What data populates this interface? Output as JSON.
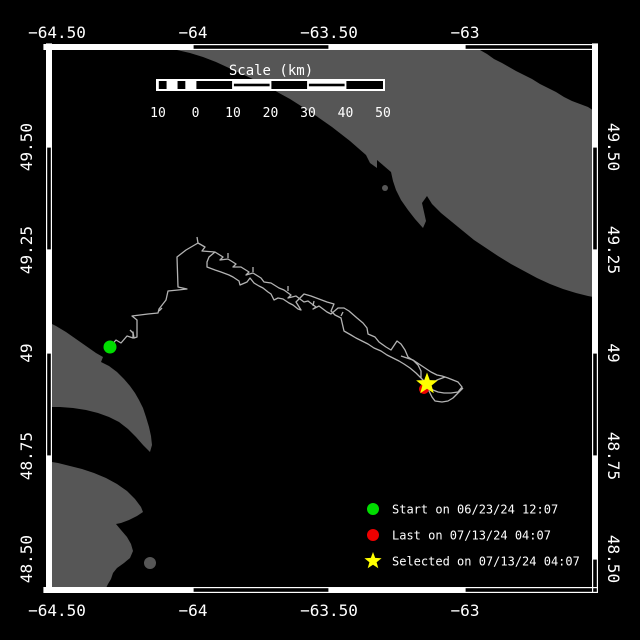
{
  "colors": {
    "background": "#000000",
    "land": "#565656",
    "track": "#b3b3b3",
    "frame": "#ffffff",
    "start": "#00dd00",
    "last": "#ee0000",
    "selected": "#ffff00"
  },
  "plot": {
    "left": 46,
    "top": 44,
    "right": 598,
    "bottom": 593,
    "band": 6,
    "inner": [
      52,
      50,
      592,
      587
    ]
  },
  "frame": {
    "top": [
      [
        44,
        193,
        "solid"
      ],
      [
        193,
        329,
        "open"
      ],
      [
        329,
        465,
        "solid"
      ],
      [
        465,
        598,
        "open"
      ]
    ],
    "bottom": [
      [
        44,
        193,
        "solid"
      ],
      [
        193,
        329,
        "open"
      ],
      [
        329,
        465,
        "solid"
      ],
      [
        465,
        598,
        "open"
      ]
    ],
    "left": [
      [
        44,
        147,
        "solid"
      ],
      [
        147,
        250,
        "open"
      ],
      [
        250,
        353,
        "solid"
      ],
      [
        353,
        456,
        "open"
      ],
      [
        456,
        593,
        "solid"
      ]
    ],
    "right": [
      [
        44,
        147,
        "solid"
      ],
      [
        147,
        250,
        "open"
      ],
      [
        250,
        353,
        "solid"
      ],
      [
        353,
        456,
        "open"
      ],
      [
        456,
        559,
        "solid"
      ],
      [
        559,
        593,
        "open"
      ]
    ]
  },
  "axes": {
    "top": [
      {
        "label": "−64.50",
        "x": 57
      },
      {
        "label": "−64",
        "x": 193
      },
      {
        "label": "−63.50",
        "x": 329
      },
      {
        "label": "−63",
        "x": 465
      }
    ],
    "bottom": [
      {
        "label": "−64.50",
        "x": 57
      },
      {
        "label": "−64",
        "x": 193
      },
      {
        "label": "−63.50",
        "x": 329
      },
      {
        "label": "−63",
        "x": 465
      }
    ],
    "left": [
      {
        "label": "49.50",
        "y": 147
      },
      {
        "label": "49.25",
        "y": 250
      },
      {
        "label": "49",
        "y": 353
      },
      {
        "label": "48.75",
        "y": 456
      },
      {
        "label": "48.50",
        "y": 559
      }
    ],
    "right": [
      {
        "label": "49.50",
        "y": 147
      },
      {
        "label": "49.25",
        "y": 250
      },
      {
        "label": "49",
        "y": 353
      },
      {
        "label": "48.75",
        "y": 456
      },
      {
        "label": "48.50",
        "y": 559
      }
    ]
  },
  "scalebar": {
    "title": "Scale (km)",
    "title_x": 271,
    "title_y": 75,
    "x": 158,
    "y": 81,
    "h": 8,
    "section_w": 37.5,
    "sections": [
      "subdivided",
      "solid",
      "striped",
      "solid",
      "striped",
      "solid"
    ],
    "labels": [
      {
        "text": "10",
        "x": 158
      },
      {
        "text": "0",
        "x": 195.5
      },
      {
        "text": "10",
        "x": 233
      },
      {
        "text": "20",
        "x": 270.5
      },
      {
        "text": "30",
        "x": 308
      },
      {
        "text": "40",
        "x": 345.5
      },
      {
        "text": "50",
        "x": 383
      }
    ],
    "labels_y": 117
  },
  "land": {
    "polygons": {
      "north_shore": [
        [
          155,
          48
        ],
        [
          250,
          49
        ],
        [
          360,
          50
        ],
        [
          480,
          50
        ],
        [
          487,
          54
        ],
        [
          494,
          59
        ],
        [
          502,
          63
        ],
        [
          509,
          67
        ],
        [
          516,
          71
        ],
        [
          524,
          75
        ],
        [
          532,
          79
        ],
        [
          540,
          84
        ],
        [
          548,
          88
        ],
        [
          556,
          92
        ],
        [
          564,
          97
        ],
        [
          572,
          101
        ],
        [
          580,
          104
        ],
        [
          588,
          107
        ],
        [
          594,
          111
        ],
        [
          598,
          114
        ],
        [
          598,
          298
        ],
        [
          588,
          296
        ],
        [
          576,
          293
        ],
        [
          563,
          289
        ],
        [
          550,
          284
        ],
        [
          537,
          278
        ],
        [
          524,
          271
        ],
        [
          511,
          264
        ],
        [
          498,
          256
        ],
        [
          486,
          248
        ],
        [
          474,
          240
        ],
        [
          463,
          231
        ],
        [
          452,
          222
        ],
        [
          441,
          213
        ],
        [
          432,
          204
        ],
        [
          427,
          196
        ],
        [
          422,
          203
        ],
        [
          426,
          221
        ],
        [
          423,
          228
        ],
        [
          415,
          219
        ],
        [
          408,
          210
        ],
        [
          401,
          200
        ],
        [
          396,
          190
        ],
        [
          393,
          181
        ],
        [
          391,
          172
        ],
        [
          384,
          166
        ],
        [
          377,
          160
        ],
        [
          377,
          168
        ],
        [
          370,
          163
        ],
        [
          366,
          155
        ],
        [
          358,
          148
        ],
        [
          350,
          141
        ],
        [
          341,
          134
        ],
        [
          332,
          127
        ],
        [
          322,
          120
        ],
        [
          312,
          113
        ],
        [
          301,
          106
        ],
        [
          290,
          99
        ],
        [
          279,
          93
        ],
        [
          267,
          86
        ],
        [
          255,
          80
        ],
        [
          242,
          74
        ],
        [
          229,
          68
        ],
        [
          216,
          62
        ],
        [
          203,
          57
        ],
        [
          190,
          53
        ],
        [
          177,
          50
        ],
        [
          166,
          49
        ]
      ],
      "gaspe_upper": [
        [
          46,
          321
        ],
        [
          56,
          326
        ],
        [
          66,
          332
        ],
        [
          76,
          339
        ],
        [
          86,
          346
        ],
        [
          96,
          353
        ],
        [
          103,
          357
        ],
        [
          101,
          362
        ],
        [
          109,
          366
        ],
        [
          117,
          372
        ],
        [
          124,
          379
        ],
        [
          130,
          386
        ],
        [
          135,
          393
        ],
        [
          139,
          400
        ],
        [
          143,
          408
        ],
        [
          146,
          417
        ],
        [
          149,
          427
        ],
        [
          151,
          436
        ],
        [
          152,
          445
        ],
        [
          150,
          452
        ],
        [
          143,
          445
        ],
        [
          136,
          437
        ],
        [
          128,
          429
        ],
        [
          119,
          422
        ],
        [
          109,
          417
        ],
        [
          98,
          413
        ],
        [
          86,
          410
        ],
        [
          73,
          408
        ],
        [
          60,
          407
        ],
        [
          46,
          407
        ]
      ],
      "gaspe_lower": [
        [
          46,
          461
        ],
        [
          58,
          463
        ],
        [
          70,
          466
        ],
        [
          82,
          469
        ],
        [
          94,
          473
        ],
        [
          106,
          478
        ],
        [
          117,
          484
        ],
        [
          127,
          491
        ],
        [
          135,
          499
        ],
        [
          141,
          507
        ],
        [
          143,
          512
        ],
        [
          137,
          516
        ],
        [
          129,
          520
        ],
        [
          121,
          523
        ],
        [
          116,
          524
        ],
        [
          121,
          530
        ],
        [
          127,
          537
        ],
        [
          131,
          544
        ],
        [
          133,
          551
        ],
        [
          130,
          558
        ],
        [
          124,
          563
        ],
        [
          117,
          568
        ],
        [
          113,
          573
        ],
        [
          111,
          579
        ],
        [
          108,
          584
        ],
        [
          106,
          588
        ],
        [
          46,
          588
        ]
      ]
    },
    "islets": [
      {
        "cx": 385,
        "cy": 188,
        "r": 3
      },
      {
        "cx": 150,
        "cy": 563,
        "r": 6
      }
    ]
  },
  "track": {
    "polylines": [
      [
        [
          110,
          347
        ],
        [
          116,
          340
        ],
        [
          121,
          343
        ],
        [
          127,
          336
        ],
        [
          133,
          338
        ],
        [
          133,
          332
        ],
        [
          134,
          338
        ],
        [
          137,
          337
        ],
        [
          137,
          320
        ],
        [
          132,
          316
        ],
        [
          148,
          314
        ],
        [
          158,
          313
        ],
        [
          159,
          309
        ],
        [
          166,
          300
        ],
        [
          168,
          291
        ],
        [
          178,
          290
        ],
        [
          187,
          289
        ],
        [
          178,
          287
        ],
        [
          177,
          257
        ],
        [
          186,
          250
        ],
        [
          198,
          243
        ]
      ],
      [
        [
          198,
          243
        ],
        [
          197,
          237
        ]
      ],
      [
        [
          198,
          243
        ],
        [
          205,
          247
        ],
        [
          202,
          251
        ],
        [
          215,
          252
        ],
        [
          223,
          257
        ],
        [
          220,
          260
        ],
        [
          228,
          259
        ],
        [
          236,
          264
        ],
        [
          233,
          267
        ],
        [
          241,
          267
        ],
        [
          249,
          272
        ],
        [
          246,
          275
        ],
        [
          253,
          273
        ],
        [
          261,
          278
        ],
        [
          264,
          282
        ],
        [
          271,
          283
        ],
        [
          279,
          288
        ],
        [
          284,
          290
        ],
        [
          291,
          295
        ],
        [
          288,
          298
        ],
        [
          296,
          296
        ],
        [
          304,
          302
        ],
        [
          308,
          301
        ],
        [
          316,
          307
        ],
        [
          313,
          309
        ],
        [
          319,
          306
        ],
        [
          327,
          312
        ],
        [
          331,
          314
        ],
        [
          338,
          308
        ],
        [
          344,
          308
        ],
        [
          349,
          311
        ],
        [
          357,
          318
        ],
        [
          363,
          323
        ],
        [
          367,
          328
        ],
        [
          368,
          334
        ],
        [
          375,
          337
        ],
        [
          379,
          342
        ],
        [
          386,
          347
        ],
        [
          391,
          350
        ],
        [
          397,
          341
        ],
        [
          401,
          344
        ],
        [
          405,
          350
        ],
        [
          408,
          357
        ],
        [
          414,
          361
        ],
        [
          418,
          365
        ],
        [
          421,
          371
        ],
        [
          421,
          378
        ],
        [
          425,
          382
        ],
        [
          427,
          385
        ]
      ],
      [
        [
          215,
          252
        ],
        [
          209,
          257
        ],
        [
          207,
          262
        ],
        [
          207,
          267
        ],
        [
          215,
          270
        ],
        [
          221,
          272
        ],
        [
          229,
          275
        ],
        [
          233,
          277
        ],
        [
          239,
          281
        ],
        [
          240,
          285
        ],
        [
          247,
          282
        ],
        [
          250,
          278
        ],
        [
          254,
          283
        ],
        [
          259,
          286
        ],
        [
          263,
          288
        ],
        [
          268,
          292
        ],
        [
          271,
          294
        ],
        [
          274,
          300
        ],
        [
          278,
          298
        ],
        [
          283,
          299
        ],
        [
          289,
          303
        ],
        [
          293,
          305
        ],
        [
          298,
          309
        ],
        [
          301,
          310
        ],
        [
          296,
          302
        ],
        [
          304,
          294
        ],
        [
          311,
          296
        ],
        [
          319,
          299
        ],
        [
          327,
          302
        ],
        [
          334,
          304
        ],
        [
          331,
          311
        ],
        [
          335,
          315
        ],
        [
          341,
          318
        ],
        [
          344,
          331
        ],
        [
          351,
          335
        ],
        [
          356,
          338
        ],
        [
          362,
          341
        ],
        [
          368,
          344
        ],
        [
          374,
          348
        ],
        [
          381,
          351
        ],
        [
          387,
          355
        ],
        [
          393,
          358
        ],
        [
          399,
          361
        ],
        [
          404,
          364
        ],
        [
          410,
          368
        ],
        [
          416,
          373
        ],
        [
          421,
          378
        ]
      ],
      [
        [
          427,
          385
        ],
        [
          433,
          390
        ],
        [
          438,
          392
        ],
        [
          444,
          393
        ],
        [
          451,
          393
        ],
        [
          458,
          392
        ],
        [
          462,
          387
        ],
        [
          458,
          382
        ],
        [
          453,
          380
        ],
        [
          448,
          378
        ],
        [
          445,
          377
        ],
        [
          437,
          380
        ],
        [
          431,
          384
        ],
        [
          427,
          385
        ],
        [
          429,
          391
        ],
        [
          432,
          397
        ],
        [
          435,
          401
        ],
        [
          442,
          402
        ],
        [
          448,
          401
        ],
        [
          453,
          398
        ],
        [
          457,
          394
        ],
        [
          461,
          390
        ],
        [
          463,
          388
        ]
      ],
      [
        [
          401,
          356
        ],
        [
          407,
          358
        ],
        [
          413,
          360
        ],
        [
          419,
          364
        ],
        [
          425,
          368
        ],
        [
          431,
          372
        ],
        [
          437,
          375
        ],
        [
          442,
          376
        ],
        [
          445,
          377
        ]
      ],
      [
        [
          133,
          333
        ],
        [
          130,
          330
        ]
      ],
      [
        [
          159,
          311
        ],
        [
          162,
          308
        ]
      ],
      [
        [
          228,
          258
        ],
        [
          228,
          253
        ]
      ],
      [
        [
          253,
          272
        ],
        [
          253,
          267
        ]
      ],
      [
        [
          288,
          291
        ],
        [
          288,
          286
        ]
      ],
      [
        [
          313,
          306
        ],
        [
          314,
          301
        ]
      ],
      [
        [
          341,
          316
        ],
        [
          343,
          312
        ]
      ]
    ]
  },
  "markers": {
    "start": {
      "x": 110,
      "y": 347,
      "r": 6.5
    },
    "last": {
      "x": 424,
      "y": 389,
      "r": 5
    },
    "selected": {
      "x": 427,
      "y": 384,
      "outer": 11.5,
      "inner": 4.8
    }
  },
  "legend": {
    "marker_x": 373,
    "text_x": 392,
    "rows": [
      {
        "marker": "circle",
        "color": "#00dd00",
        "y": 509,
        "label": "Start on 06/23/24 12:07"
      },
      {
        "marker": "circle",
        "color": "#ee0000",
        "y": 535,
        "label": "Last on 07/13/24 04:07"
      },
      {
        "marker": "star",
        "color": "#ffff00",
        "y": 561,
        "label": "Selected on 07/13/24 04:07"
      }
    ]
  }
}
